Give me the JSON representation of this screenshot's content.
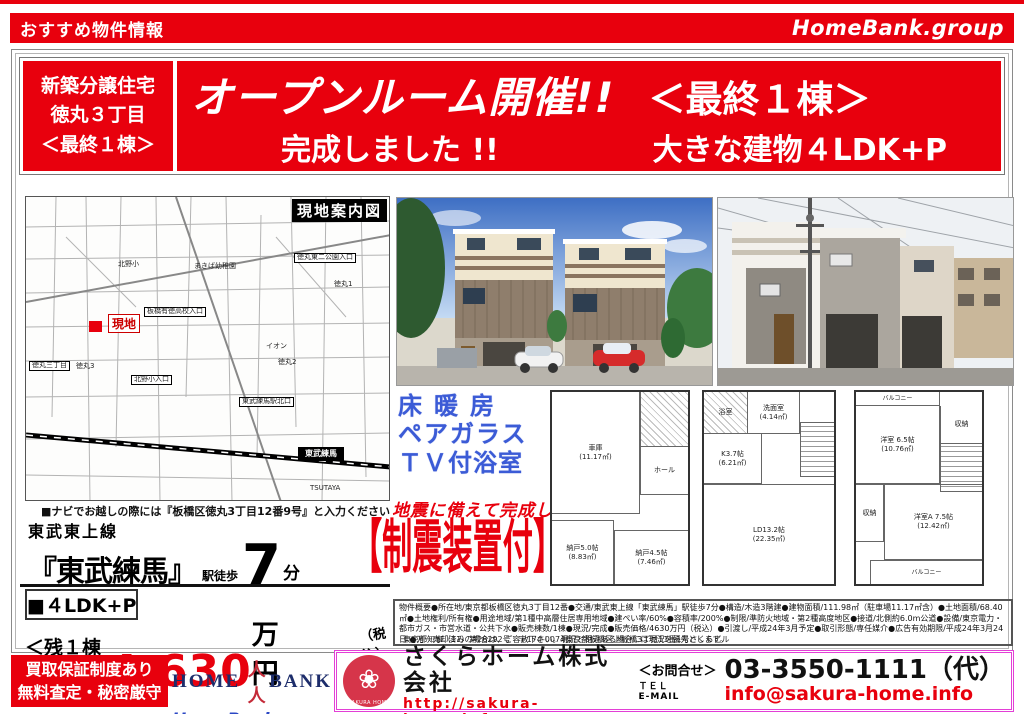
{
  "top_bar": {
    "left": "おすすめ物件情報",
    "right": "HomeBank.group"
  },
  "header": {
    "badge_lines": [
      "新築分譲住宅",
      "徳丸３丁目",
      "＜最終１棟＞"
    ],
    "title1_left": "オープンルーム開催!!",
    "title1_right": "＜最終１棟＞",
    "title2_left": "完成しました !!",
    "title2_right": "大きな建物４LDK+P"
  },
  "map": {
    "title": "現地案内図",
    "site_marker": "現地",
    "labels": [
      "北野小",
      "まきば幼稚園",
      "徳丸東二公園入口",
      "板橋有徳高校入口",
      "徳丸1",
      "イオン",
      "徳丸2",
      "徳丸3",
      "徳丸三丁目",
      "北野小入口",
      "東武練馬駅北口",
      "東武練馬",
      "TSUTAYA"
    ],
    "nav_note": "■ナビでお越しの際には『板橋区徳丸3丁目12番9号』と入力ください"
  },
  "access": {
    "line_name": "東武東上線",
    "station": "『東武練馬』",
    "walk_label": "駅徒歩",
    "minutes": "7",
    "minutes_unit": "分"
  },
  "price": {
    "plan": "■４LDK+P",
    "label": "販売価格",
    "remaining": "＜残１棟＞",
    "amount": "4,630",
    "unit": "万円",
    "tax_note": "（税込）"
  },
  "features": {
    "blue_items": [
      "床暖房",
      "ペアガラス",
      "ＴＶ付浴室"
    ],
    "earthquake_note": "地震に備えて完成しました",
    "seismic": "【制震装置付】"
  },
  "floorplans": [
    {
      "rooms": [
        "車庫\n(11.17㎡)",
        "ホール",
        "納戸5.0帖\n(8.83㎡)",
        "納戸4.5帖\n(7.46㎡)"
      ]
    },
    {
      "rooms": [
        "浴室",
        "洗面室\n(4.14㎡)",
        "K3.7帖\n(6.21㎡)",
        "LD13.2帖\n(22.35㎡)"
      ]
    },
    {
      "rooms": [
        "バルコニー",
        "洋室 6.5帖\n(10.76㎡)",
        "収納",
        "洋室A 7.5帖\n(12.42㎡)",
        "収納",
        "バルコニー"
      ]
    }
  ],
  "description": "物件概要●所在地/東京都板橋区徳丸3丁目12番●交通/東武東上線「東武練馬」駅徒歩7分●構造/木造3階建●建物面積/111.98㎡（駐車場11.17㎡含）●土地面積/68.40㎡●土地権利/所有権●用途地域/第1種中高層住居専用地域●建ぺい率/60%●容積率/200%●制限/準防火地域・第2種高度地区●接道/北側約6.0m公道●設備/東京電力・都市ガス・市営水道・公共下水●販売棟数/1棟●現況/完成●販売価格/4630万円（税込）●引渡し/平成24年3月予定●取引形態/専任媒介●広告有効期限/平成24年3月24日 ●万一売却済みの場合は、ご容赦下さい。現況と相違ある場合には現況を優先とします。",
  "footer": {
    "guarantee_lines": [
      "買取保証制度あり",
      "無料査定・秘密厳守"
    ],
    "homebank": {
      "left": "HOME",
      "people": "人人",
      "right": "BANK",
      "group": "HomeBank.group"
    },
    "company": {
      "license": "東京都知事（11）第26292号　〒174-0074東京都板橋区上板橋3丁目11番1号さくらビル",
      "name": "さくらホーム株式会社",
      "url": "http://sakura-home.info",
      "logo_caption": "SAKURA HOME",
      "contact_label": "＜お問合せ＞",
      "tel_label": "ＴＥＬ",
      "email_label": "E-MAIL",
      "tel": "03-3550-1111（代）",
      "email": "info@sakura-home.info"
    }
  }
}
